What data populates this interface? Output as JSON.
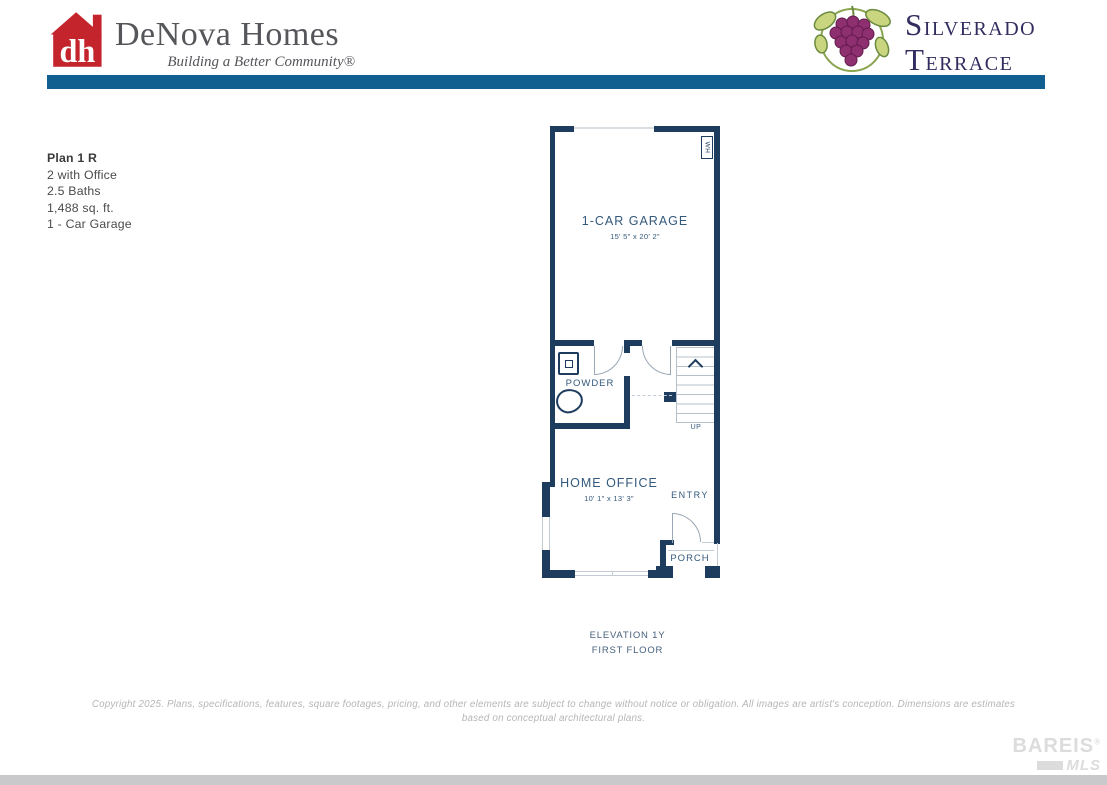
{
  "header": {
    "brand": {
      "monogram": "dh",
      "name": "DeNova Homes",
      "tagline": "Building a Better Community®"
    },
    "community": {
      "initial1": "S",
      "rest1": "ILVERADO",
      "initial2": "T",
      "rest2": "ERRACE"
    }
  },
  "plan_info": {
    "title": "Plan 1 R",
    "details": [
      "2 with Office",
      "2.5 Baths",
      "1,488 sq. ft.",
      "1 - Car Garage"
    ]
  },
  "floor_plan": {
    "garage": {
      "label": "1-CAR GARAGE",
      "dims": "15' 5\" x 20' 2\""
    },
    "powder": {
      "label": "POWDER"
    },
    "office": {
      "label": "HOME OFFICE",
      "dims": "10' 1\" x 13' 3\""
    },
    "entry": {
      "label": "ENTRY"
    },
    "porch": {
      "label": "PORCH"
    },
    "stairs": {
      "label": "UP"
    },
    "water_heater": {
      "label": "WH"
    }
  },
  "caption": {
    "elevation": "ELEVATION 1Y",
    "floor": "FIRST FLOOR"
  },
  "footer": {
    "copyright": "Copyright 2025. Plans, specifications, features, square footages, pricing, and other elements are subject to change without notice or obligation. All images are artist's conception. Dimensions are estimates based on conceptual architectural plans.",
    "watermark": {
      "line1": "BAREIS",
      "reg": "®",
      "line2": "MLS"
    }
  },
  "colors": {
    "accent_blue": "#115e90",
    "wall_navy": "#1e3c5e",
    "label_blue": "#33597c",
    "caption_blue": "#47617c",
    "brand_red": "#c4242c",
    "brand_gray": "#55565a",
    "community_navy": "#322d5f",
    "grape_purple": "#8e2f6f",
    "grape_outline": "#641c4e",
    "leaf_green": "#c9d67f",
    "leaf_outline": "#6b8a3f",
    "vine_green": "#8aa54f",
    "line_gray": "#9aa7b4",
    "light_line": "#c3ccd4",
    "tread_gray": "#b6c0ca",
    "garage_door_line": "#d9dee3",
    "footer_gray": "#b6b6b8",
    "watermark_gray": "#dcdcdc",
    "bottom_bar": "#c9c9cb"
  }
}
